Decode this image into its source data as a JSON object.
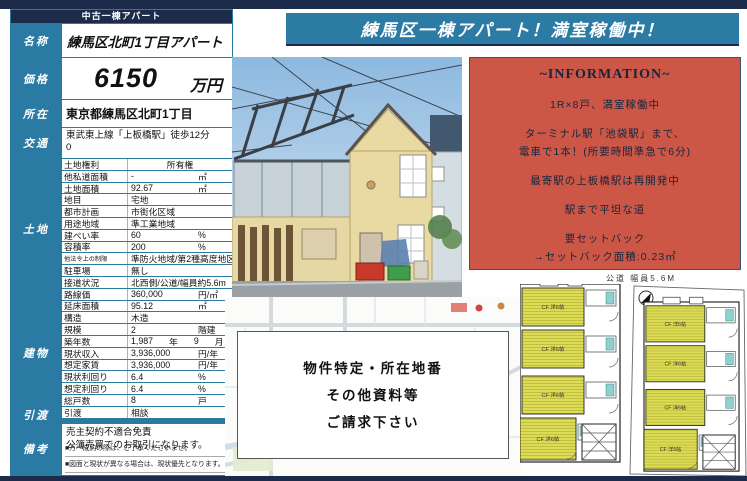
{
  "page": {
    "doc_type": "中古一棟アパート",
    "banner": "練馬区一棟アパート！満室稼働中！"
  },
  "colors": {
    "navy": "#1b2b49",
    "teal": "#2a7aa3",
    "info_bg": "#cd5746",
    "plan_room": "#dcdc55"
  },
  "summary": {
    "name_label": "名称",
    "name": "練馬区北町1丁目アパート",
    "price_label": "価格",
    "price": "6150",
    "price_unit": "万円",
    "location_label": "所在",
    "location": "東京都練馬区北町1丁目",
    "access_label": "交通",
    "access_line1": "東武東上線「上板橋駅」徒歩12分",
    "access_line2": "0"
  },
  "land": {
    "label": "土地",
    "rows": [
      {
        "label": "土地権利",
        "value": "所有権"
      },
      {
        "label": "他私道面積",
        "value": "-",
        "unit": "㎡"
      },
      {
        "label": "土地面積",
        "value": "92.67",
        "unit": "㎡"
      },
      {
        "label": "地目",
        "value": "宅地"
      },
      {
        "label": "都市計画",
        "value": "市街化区域"
      },
      {
        "label": "用途地域",
        "value": "準工業地域"
      },
      {
        "label": "建ぺい率",
        "value": "60",
        "unit": "%"
      },
      {
        "label": "容積率",
        "value": "200",
        "unit": "%"
      },
      {
        "label": "他法令上の制限",
        "value": "準防火地域/第2種高度地区"
      },
      {
        "label": "駐車場",
        "value": "無し"
      },
      {
        "label": "接道状況",
        "value": "北西側/公道/幅員約5.6m"
      },
      {
        "label": "路線価",
        "value": "360,000",
        "unit": "円/㎡"
      }
    ]
  },
  "building": {
    "label": "建物",
    "rows": [
      {
        "label": "延床面積",
        "value": "95.12",
        "unit": "㎡"
      },
      {
        "label": "構造",
        "value": "木造"
      },
      {
        "label": "規模",
        "value": "2",
        "unit": "階建"
      },
      {
        "label": "築年数",
        "value": "1,987",
        "unit": "年",
        "value2": "9",
        "unit2": "月"
      },
      {
        "label": "現状収入",
        "value": "3,936,000",
        "unit": "円/年"
      },
      {
        "label": "想定家賃",
        "value": "3,936,000",
        "unit": "円/年"
      },
      {
        "label": "現状利回り",
        "value": "6.4",
        "unit": "%"
      },
      {
        "label": "想定利回り",
        "value": "6.4",
        "unit": "%"
      },
      {
        "label": "総戸数",
        "value": "8",
        "unit": "戸"
      }
    ]
  },
  "handover": {
    "label": "引渡",
    "row_label": "引渡",
    "value": "相談"
  },
  "remarks": {
    "label": "備考",
    "lines": [
      "売主契約不適合免責",
      "公簿売買でのお取引になります。"
    ],
    "footnotes": [
      "■万一成約の際は、ご了承くださいませ。",
      "■図面と現状が異なる場合は、現状優先となります。"
    ]
  },
  "information": {
    "title": "~INFORMATION~",
    "lines": [
      "1R×8戸、満室稼働中",
      "ターミナル駅「池袋駅」まで、",
      "電車で1本！(所要時間準急で6分)",
      "最寄駅の上板橋駅は再開発中",
      "駅まで平坦な道",
      "要セットバック",
      "→セットバック面積:0.23㎡"
    ]
  },
  "map_overlay": {
    "line1": "物件特定・所在地番",
    "line2": "その他資料等",
    "line3": "ご請求下さい"
  },
  "plans": {
    "road_label": "公道 幅員5.6M",
    "room_label": "CF 洋6帖"
  }
}
